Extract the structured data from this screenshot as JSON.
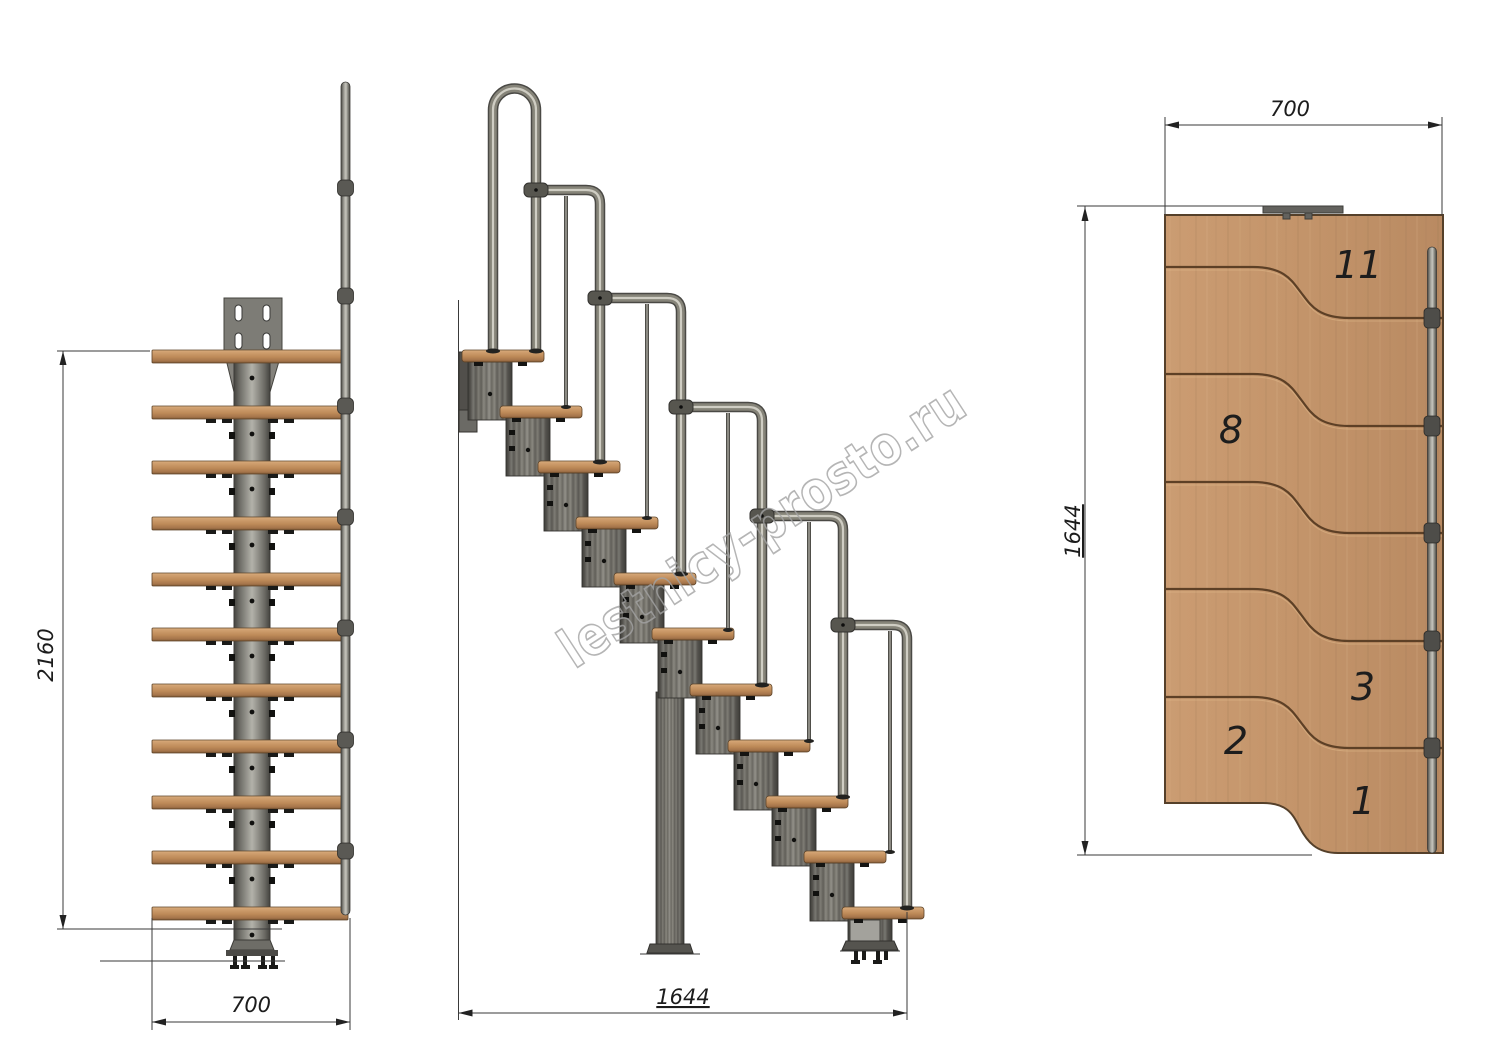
{
  "watermark": {
    "text": "lestnicy-prosto.ru"
  },
  "dimensions": {
    "front_height": "2160",
    "front_width": "700",
    "side_length": "1644",
    "plan_width": "700",
    "plan_length": "1644"
  },
  "plan": {
    "step_labels": [
      "11",
      "8",
      "3",
      "2",
      "1"
    ]
  },
  "colors": {
    "wood": "#c3946a",
    "steel_column": "#8f8d86",
    "handrail_tube": "#868479",
    "dimension_line": "#3a3a3a",
    "watermark_outline": "#a3a3a3"
  }
}
